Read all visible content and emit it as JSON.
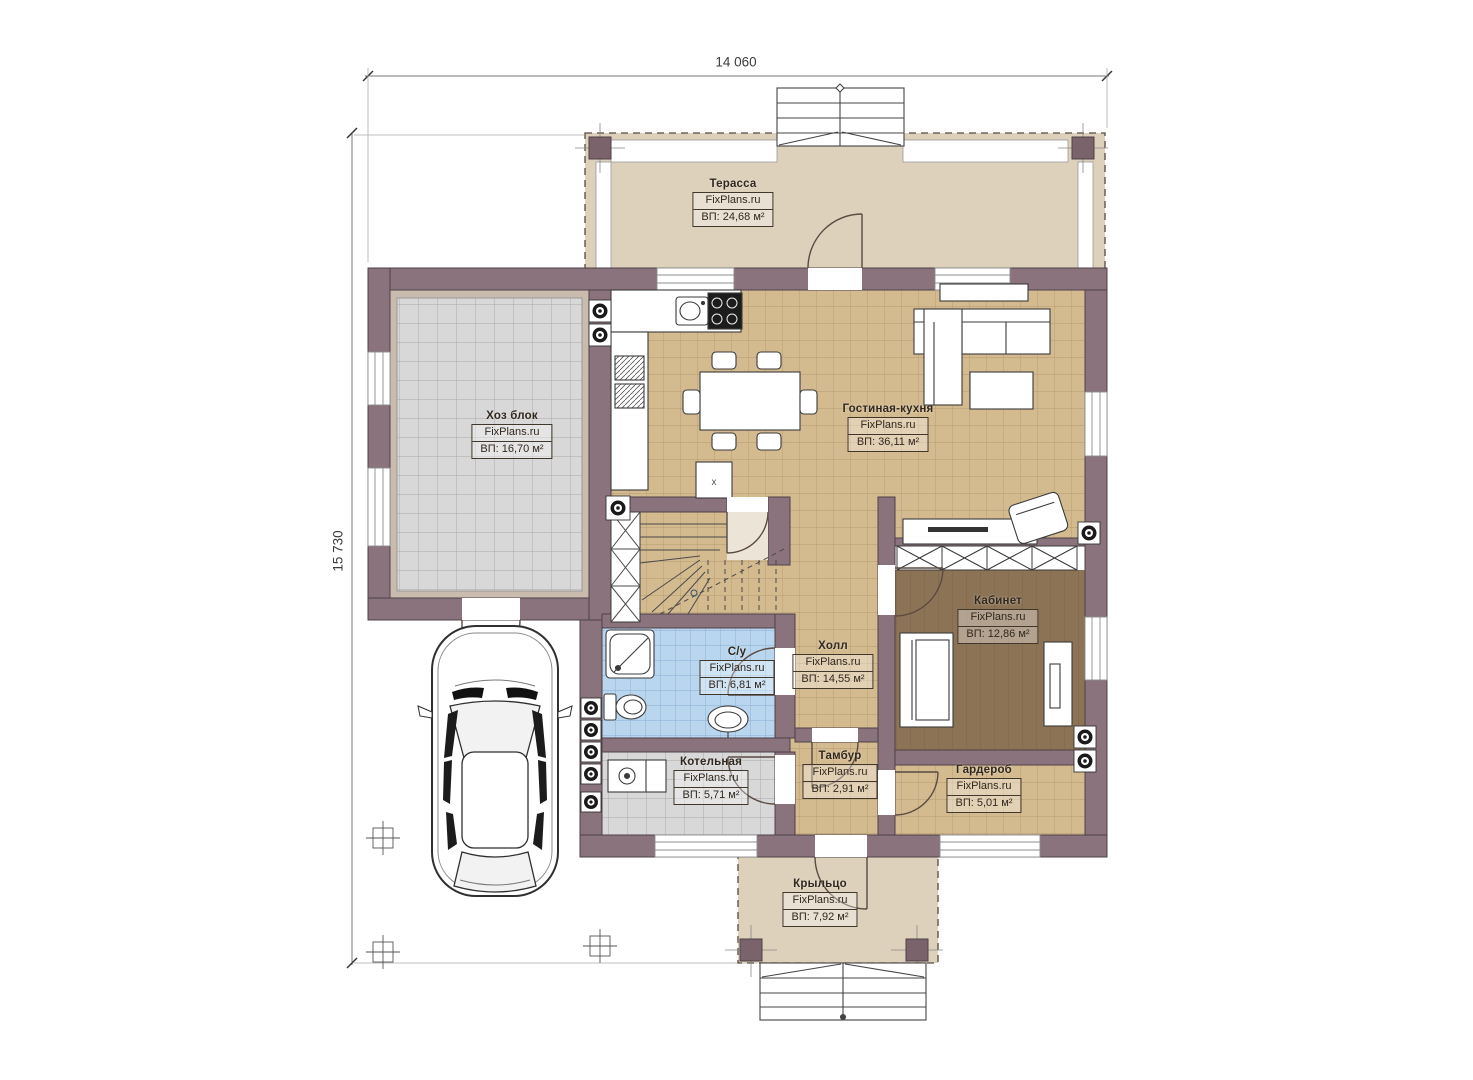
{
  "watermark": "FixPlans.ru",
  "dimensions": {
    "width": "14 060",
    "height": "15 730"
  },
  "rooms": [
    {
      "key": "terrace",
      "name": "Терасса",
      "area": "ВП: 24,68 м²"
    },
    {
      "key": "utility-block",
      "name": "Хоз блок",
      "area": "ВП: 16,70 м²"
    },
    {
      "key": "living-kitchen",
      "name": "Гостиная-кухня",
      "area": "ВП: 36,11 м²"
    },
    {
      "key": "office",
      "name": "Кабинет",
      "area": "ВП: 12,86 м²"
    },
    {
      "key": "bathroom",
      "name": "С/у",
      "area": "ВП: 6,81 м²"
    },
    {
      "key": "hall",
      "name": "Холл",
      "area": "ВП: 14,55 м²"
    },
    {
      "key": "boiler-room",
      "name": "Котельная",
      "area": "ВП: 5,71 м²"
    },
    {
      "key": "vestibule",
      "name": "Тамбур",
      "area": "ВП: 2,91 м²"
    },
    {
      "key": "wardrobe",
      "name": "Гардероб",
      "area": "ВП: 5,01 м²"
    },
    {
      "key": "porch",
      "name": "Крыльцо",
      "area": "ВП: 7,92 м²"
    }
  ],
  "misc": {
    "hatch_mark": "x"
  },
  "colors": {
    "wall": "#8a737c",
    "wall_outline": "#4e4148",
    "terrace_floor": "#ddd1bc",
    "tan_floor": "#d4ba8f",
    "grey_floor": "#d8d8d8",
    "blue_floor": "#b9d6ee",
    "office_floor": "#8c7355",
    "line": "#3b3b3b"
  }
}
